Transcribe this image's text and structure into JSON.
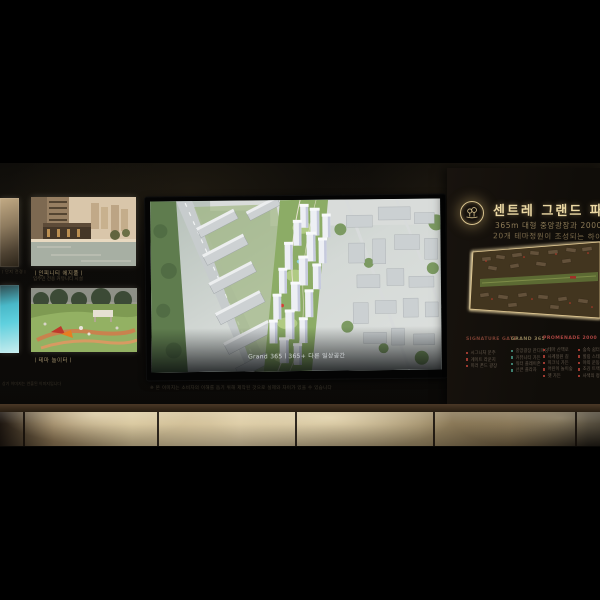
{
  "left_gallery": {
    "edge_caption": "ㅣ단지 전경ㅣ",
    "panels": [
      {
        "caption": "ㅣ인피니티 에지풀ㅣ",
        "subcaption": "입주민 전용 커뮤니티 시설"
      },
      {
        "caption": "ㅣ테마 놀이터ㅣ"
      }
    ],
    "side_note": "상기 이미지는 연출된 이미지입니다"
  },
  "screen": {
    "caption": "Grand 365ㅣ365+ 다른 일상공간"
  },
  "disclaimer": "※ 본 이미지는 소비자의 이해를 돕기 위해 제작된 것으로 실제와 차이가 있을 수 있습니다",
  "signage": {
    "title": "센트레 그랜드 파크",
    "subtitle_line1": "365m 대형 중앙광장과 2000m 산책로",
    "subtitle_line2": "20개 테마정원이 조성되는 하이엔드 조경",
    "logo_icon": "twin-trees-emblem-icon",
    "accent_color": "#d9c48f",
    "columns": [
      {
        "header": "SIGNATURE GATE",
        "header_color": "#7a3f32",
        "bullet_color": "#9c3a30",
        "items": [
          "시그니처 문주",
          "게이트 라운지",
          "미러 폰드 광장"
        ]
      },
      {
        "header": "GRAND 365",
        "header_color": "#8f7f58",
        "bullet_color": "#3f7f6f",
        "items": [
          "중앙광장 잔디마당",
          "커뮤니티 가든",
          "워터 플레이존",
          "선큰 플라자"
        ]
      },
      {
        "header": "PROMENADE 2000",
        "header_color": "#a84440",
        "bullet_color": "#9c3a30",
        "items": [
          "테마 산책로",
          "사계정원 길",
          "피크닉 가든",
          "어린이 놀이숲",
          "펫 가든"
        ],
        "items2": [
          "숲속 쉼터",
          "힐링 스테이션",
          "야외 운동공간",
          "조깅 트랙",
          "사색의 정원"
        ]
      }
    ]
  }
}
